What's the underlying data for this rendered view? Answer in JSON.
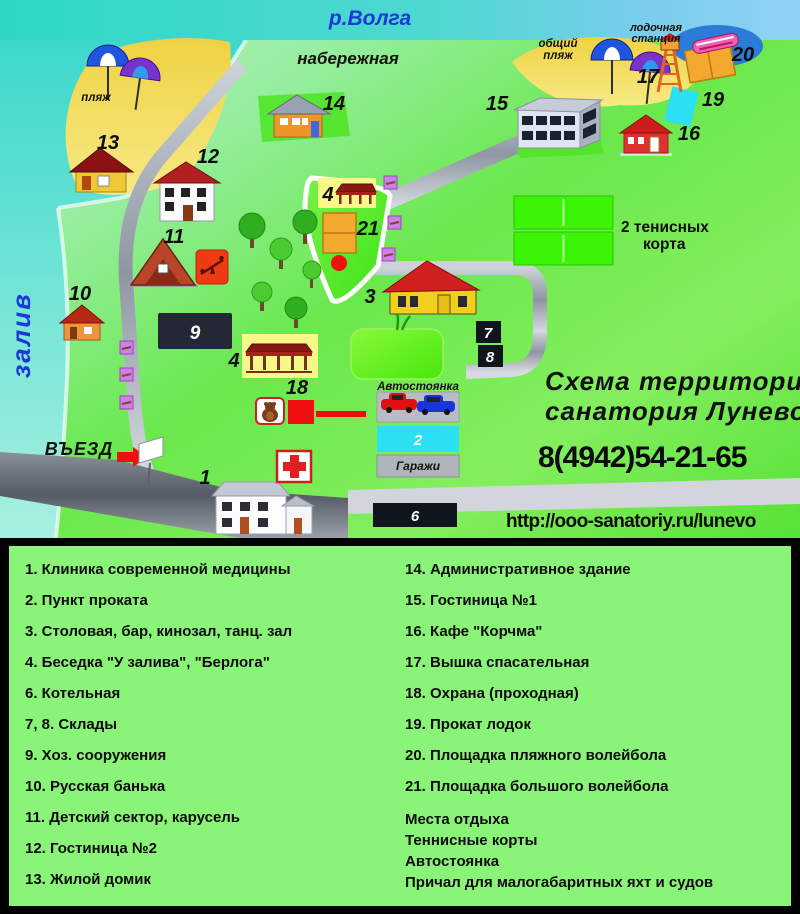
{
  "map": {
    "water": {
      "river": "р.Волга",
      "bay": "залив",
      "embankment": "набережная",
      "beach": "пляж",
      "common_beach_line1": "общий",
      "common_beach_line2": "пляж",
      "boat_station_line1": "лодочная",
      "boat_station_line2": "станция"
    },
    "entrance": "ВЪЕЗД",
    "parking": "Автостоянка",
    "garages": "Гаражи",
    "tennis_line1": "2 тенисных",
    "tennis_line2": "корта",
    "title_line1": "Схема территории",
    "title_line2": "санатория Лунево",
    "phone": "8(4942)54-21-65",
    "url": "http://ooo-sanatoriy.ru/lunevo",
    "markers": {
      "m1": "1",
      "m2": "2",
      "m3": "3",
      "m4a": "4",
      "m4b": "4",
      "m6": "6",
      "m7": "7",
      "m8": "8",
      "m9": "9",
      "m10": "10",
      "m11": "11",
      "m12": "12",
      "m13": "13",
      "m14": "14",
      "m15": "15",
      "m16": "16",
      "m17": "17",
      "m18": "18",
      "m19": "19",
      "m20": "20",
      "m21": "21"
    },
    "colors": {
      "accent_red": "#e81313",
      "water_teal": "#35dcc8",
      "water_blue": "#8fd2f4",
      "beach_yellow": "#f2dd55",
      "road_gray": "#aab2bc",
      "tennis_green": "#3cf406",
      "pool_green": "#46e80e",
      "cyan": "#2ae0f2",
      "orange": "#f2a92e",
      "legend_green": "#8af478",
      "text_blue": "#1b38d8"
    }
  },
  "legend": {
    "left": [
      "1. Клиника современной медицины",
      "2. Пункт проката",
      "3. Столовая, бар, кинозал, танц. зал",
      "4. Беседка  \"У залива\", \"Берлога\"",
      "6. Котельная",
      "7, 8. Склады",
      "9. Хоз. сооружения",
      "10. Русская банька",
      "11. Детский сектор, карусель",
      "12. Гостиница №2",
      "13. Жилой домик"
    ],
    "right": [
      "14. Административное здание",
      "15. Гостиница №1",
      "16. Кафе \"Корчма\"",
      "17. Вышка спасательная",
      "18. Охрана (проходная)",
      "19. Прокат лодок",
      "20. Площадка пляжного волейбола",
      "21. Площадка большого волейбола"
    ],
    "extras": [
      "Места отдыха",
      "Теннисные корты",
      "Автостоянка",
      "Причал для малогабаритных яхт и судов"
    ]
  }
}
